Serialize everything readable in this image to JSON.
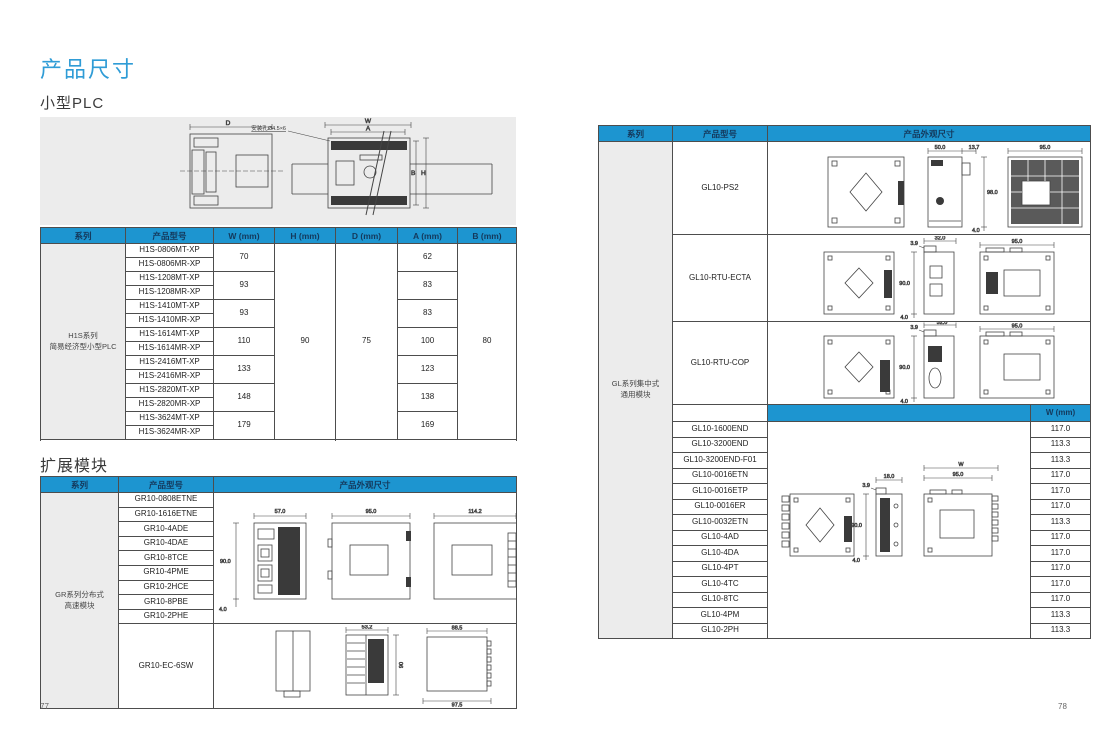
{
  "page": {
    "title": "产品尺寸",
    "section_small_plc": "小型PLC",
    "section_expansion": "扩展模块",
    "page_left": "77",
    "page_right": "78"
  },
  "colors": {
    "accent": "#1d95d0",
    "accent_text": "#14395c",
    "title_blue": "#2f9cd6",
    "cell_gray": "#ececec"
  },
  "headers": {
    "series": "系列",
    "model": "产品型号",
    "appearance": "产品外观尺寸",
    "w": "W (mm)",
    "h": "H (mm)",
    "d": "D (mm)",
    "a": "A (mm)",
    "b": "B (mm)"
  },
  "overview": {
    "d": "D",
    "w": "W",
    "a": "A",
    "b": "B",
    "h": "H",
    "hole": "安装孔Ø4.5×6"
  },
  "h1s": {
    "series1": "H1S系列",
    "series2": "简易经济型小型PLC",
    "h": "90",
    "d": "75",
    "b": "80",
    "groups": [
      {
        "m1": "H1S-0806MT-XP",
        "m2": "H1S-0806MR-XP",
        "w": "70",
        "a": "62"
      },
      {
        "m1": "H1S-1208MT-XP",
        "m2": "H1S-1208MR-XP",
        "w": "93",
        "a": "83"
      },
      {
        "m1": "H1S-1410MT-XP",
        "m2": "H1S-1410MR-XP",
        "w": "93",
        "a": "83"
      },
      {
        "m1": "H1S-1614MT-XP",
        "m2": "H1S-1614MR-XP",
        "w": "110",
        "a": "100"
      },
      {
        "m1": "H1S-2416MT-XP",
        "m2": "H1S-2416MR-XP",
        "w": "133",
        "a": "123"
      },
      {
        "m1": "H1S-2820MT-XP",
        "m2": "H1S-2820MR-XP",
        "w": "148",
        "a": "138"
      },
      {
        "m1": "H1S-3624MT-XP",
        "m2": "H1S-3624MR-XP",
        "w": "179",
        "a": "169"
      }
    ]
  },
  "gr": {
    "series1": "GR系列分布式",
    "series2": "高速模块",
    "models": [
      "GR10-0808ETNE",
      "GR10-1616ETNE",
      "GR10-4ADE",
      "GR10-4DAE",
      "GR10-8TCE",
      "GR10-4PME",
      "GR10-2HCE",
      "GR10-8PBE",
      "GR10-2PHE"
    ],
    "last_model": "GR10-EC-6SW",
    "draw1": {
      "w1": "57.0",
      "w2": "95.0",
      "w3": "114.2",
      "h": "90.0",
      "off": "4.0"
    },
    "draw2": {
      "w1": "53.2",
      "w2": "88.5",
      "h": "90",
      "wb": "97.5"
    }
  },
  "gl": {
    "series1": "GL系列集中式",
    "series2": "通用模块",
    "rows_top": [
      {
        "model": "GL10-PS2"
      },
      {
        "model": "GL10-RTU-ECTA"
      },
      {
        "model": "GL10-RTU-COP"
      }
    ],
    "ps2": {
      "a": "50.0",
      "b": "13.7",
      "c": "95.0",
      "h": "98.0",
      "off": "4.0"
    },
    "ecta": {
      "a": "32.0",
      "b": "3.9",
      "c": "95.0",
      "h": "90.0",
      "off": "4.0"
    },
    "cop": {
      "a": "32.0",
      "b": "3.9",
      "c": "95.0",
      "h": "90.0",
      "off": "4.0"
    },
    "w_col": "W (mm)",
    "rows": [
      {
        "model": "GL10-1600END",
        "w": "117.0"
      },
      {
        "model": "GL10-3200END",
        "w": "113.3"
      },
      {
        "model": "GL10-3200END-F01",
        "w": "113.3"
      },
      {
        "model": "GL10-0016ETN",
        "w": "117.0"
      },
      {
        "model": "GL10-0016ETP",
        "w": "117.0"
      },
      {
        "model": "GL10-0016ER",
        "w": "117.0"
      },
      {
        "model": "GL10-0032ETN",
        "w": "113.3"
      },
      {
        "model": "GL10-4AD",
        "w": "117.0"
      },
      {
        "model": "GL10-4DA",
        "w": "117.0"
      },
      {
        "model": "GL10-4PT",
        "w": "117.0"
      },
      {
        "model": "GL10-4TC",
        "w": "117.0"
      },
      {
        "model": "GL10-8TC",
        "w": "117.0"
      },
      {
        "model": "GL10-4PM",
        "w": "113.3"
      },
      {
        "model": "GL10-2PH",
        "w": "113.3"
      }
    ],
    "draw": {
      "a": "18.0",
      "b": "3.9",
      "w": "W",
      "c": "95.0",
      "h": "90.0",
      "off": "4.0"
    }
  }
}
